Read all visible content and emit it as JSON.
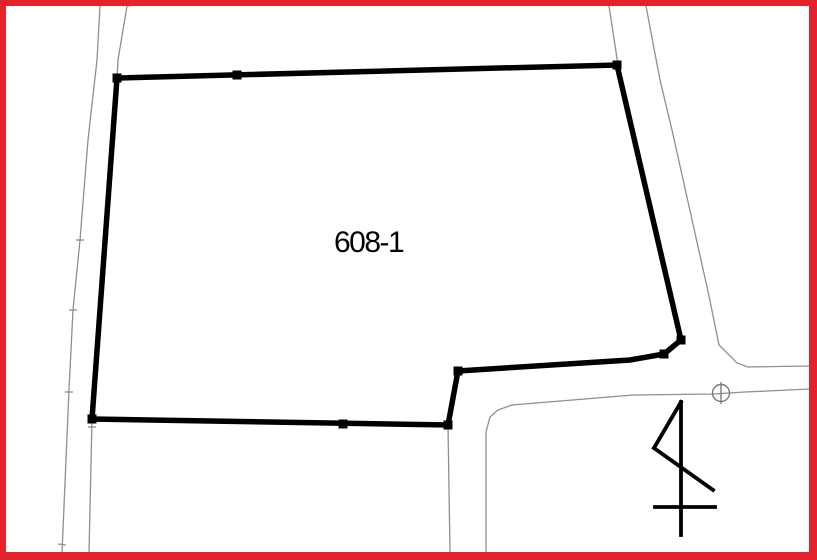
{
  "canvas": {
    "width": 817,
    "height": 560,
    "background": "#ffffff"
  },
  "frame": {
    "color": "#e3222b",
    "thickness": {
      "top": 6,
      "right": 8,
      "bottom": 8,
      "left": 6
    }
  },
  "parcel": {
    "label": "608-1",
    "label_pos": {
      "x": 334,
      "y": 228,
      "font_size": 30
    },
    "outline_color": "#000000",
    "stroke_width": 5.5,
    "points": [
      [
        117,
        78
      ],
      [
        617,
        65
      ],
      [
        681,
        340
      ],
      [
        664,
        354
      ],
      [
        630,
        360
      ],
      [
        458,
        371
      ],
      [
        448,
        425
      ],
      [
        92,
        419
      ]
    ],
    "vertex_marker_size": 9,
    "vertex_markers": [
      [
        117,
        78
      ],
      [
        237,
        75
      ],
      [
        617,
        65
      ],
      [
        681,
        340
      ],
      [
        664,
        354
      ],
      [
        458,
        371
      ],
      [
        448,
        425
      ],
      [
        343,
        424
      ],
      [
        92,
        419
      ]
    ]
  },
  "boundary_lines": {
    "color": "#8f8f8f",
    "stroke_width": 1.3,
    "polylines": [
      {
        "name": "left-road-outer-line",
        "points": [
          [
            100,
            6
          ],
          [
            97,
            60
          ],
          [
            88,
            140
          ],
          [
            80,
            240
          ],
          [
            73,
            310
          ],
          [
            69,
            390
          ],
          [
            62,
            553
          ]
        ]
      },
      {
        "name": "left-road-inner-line",
        "points": [
          [
            127,
            6
          ],
          [
            118,
            60
          ],
          [
            117,
            78
          ],
          [
            92,
            419
          ],
          [
            89,
            553
          ]
        ]
      },
      {
        "name": "right-road-inner-line",
        "points": [
          [
            609,
            6
          ],
          [
            618,
            65
          ],
          [
            681,
            342
          ]
        ]
      },
      {
        "name": "right-road-outer-line",
        "points": [
          [
            646,
            6
          ],
          [
            660,
            80
          ],
          [
            672,
            130
          ],
          [
            709,
            296
          ],
          [
            719,
            345
          ],
          [
            737,
            363
          ],
          [
            748,
            367
          ],
          [
            810,
            366
          ]
        ]
      },
      {
        "name": "south-road-upper-line",
        "points": [
          [
            486,
            552
          ],
          [
            486,
            432
          ],
          [
            490,
            417
          ],
          [
            498,
            410
          ],
          [
            512,
            405
          ],
          [
            633,
            395
          ],
          [
            713,
            394
          ],
          [
            745,
            392
          ],
          [
            810,
            389
          ]
        ]
      },
      {
        "name": "notch-boundary-line",
        "points": [
          [
            448,
            425
          ],
          [
            450,
            552
          ]
        ]
      },
      {
        "name": "bottom-edge-underlay-line",
        "points": [
          [
            92,
            421
          ],
          [
            448,
            426
          ]
        ]
      }
    ],
    "ticks": [
      [
        [
          76,
          240
        ],
        [
          84,
          240
        ]
      ],
      [
        [
          69,
          310
        ],
        [
          77,
          310
        ]
      ],
      [
        [
          65,
          392
        ],
        [
          73,
          392
        ]
      ],
      [
        [
          58,
          544
        ],
        [
          66,
          545
        ]
      ],
      [
        [
          88,
          427
        ],
        [
          96,
          427
        ]
      ],
      [
        [
          123,
          5
        ],
        [
          131,
          6
        ]
      ]
    ]
  },
  "benchmark_symbol": {
    "color": "#7a7a7a",
    "cx": 721,
    "cy": 393,
    "r": 8.5,
    "stroke_width": 1.4,
    "vertical_line": [
      [
        721,
        382
      ],
      [
        721,
        404
      ]
    ]
  },
  "north_arrow": {
    "color": "#000000",
    "stroke_width": 3.8,
    "lines": [
      [
        [
          681,
          402
        ],
        [
          681,
          535
        ]
      ],
      [
        [
          681,
          402
        ],
        [
          654,
          448
        ]
      ],
      [
        [
          654,
          448
        ],
        [
          713,
          490
        ]
      ],
      [
        [
          655,
          507
        ],
        [
          715,
          507
        ]
      ]
    ]
  }
}
